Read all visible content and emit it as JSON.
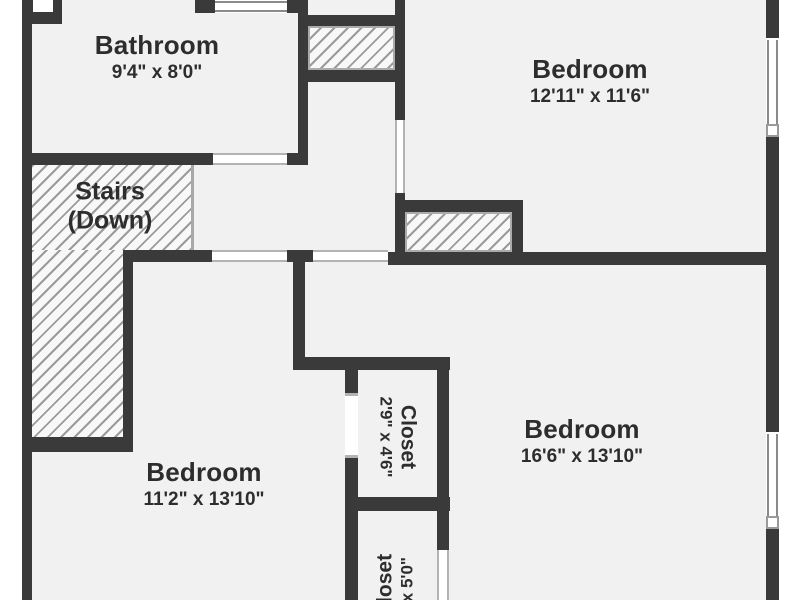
{
  "colors": {
    "wall": "#3a3a3a",
    "floor": "#f1f1f1",
    "hatch_line": "#9b9b9b",
    "hatch_bg": "#f8f8f8",
    "text": "#2d2d2d",
    "opening_line": "#b3b3b3",
    "window_line": "#8a8a8a"
  },
  "rooms": {
    "bathroom": {
      "name": "Bathroom",
      "dims": "9'4\" x 8'0\""
    },
    "bedroom_top_right": {
      "name": "Bedroom",
      "dims": "12'11\" x 11'6\""
    },
    "stairs": {
      "name": "Stairs",
      "sub": "(Down)"
    },
    "bedroom_bottom_left": {
      "name": "Bedroom",
      "dims": "11'2\" x 13'10\""
    },
    "bedroom_bottom_right": {
      "name": "Bedroom",
      "dims": "16'6\" x 13'10\""
    },
    "closet_upper": {
      "name": "Closet",
      "dims": "2'9\" x 4'6\""
    },
    "closet_lower": {
      "name": "Closet",
      "dims": "\" x 5'0\""
    }
  }
}
